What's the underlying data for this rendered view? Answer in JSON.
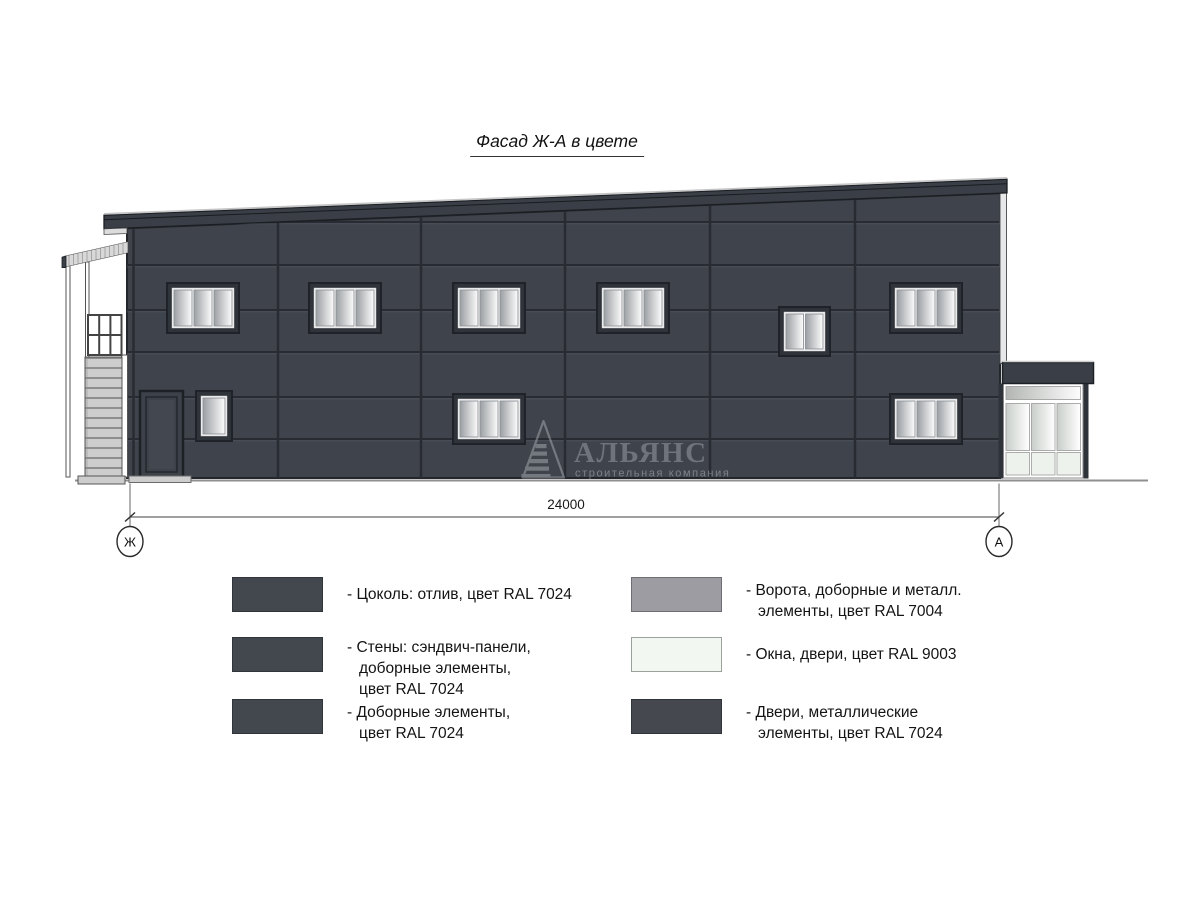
{
  "title": "Фасад Ж-А в цвете",
  "drawing": {
    "dimension_total": "24000",
    "axis_left": "Ж",
    "axis_right": "А",
    "watermark_name": "АЛЬЯНС",
    "watermark_subtitle": "строительная компания"
  },
  "colors": {
    "facade_ral7024": "#3f444c",
    "metal_ral7004": "#9c9ca2",
    "windows_ral9003": "#f2f7f1"
  },
  "legend": {
    "left": [
      {
        "swatch": "#43474e",
        "border": "#30343b",
        "text": "- Цоколь: отлив, цвет RAL 7024"
      },
      {
        "swatch": "#43474e",
        "border": "#30343b",
        "text": "- Стены: сэндвич-панели,\nдоборные элементы,\nцвет RAL 7024"
      },
      {
        "swatch": "#43474e",
        "border": "#30343b",
        "text": "- Доборные элементы,\nцвет RAL 7024"
      }
    ],
    "right": [
      {
        "swatch": "#9c9ca2",
        "border": "#6d6d73",
        "text": "- Ворота, доборные и металл.\nэлементы, цвет RAL 7004"
      },
      {
        "swatch": "#f2f7f1",
        "border": "#9aa29b",
        "text": "- Окна, двери, цвет RAL 9003"
      },
      {
        "swatch": "#45494f",
        "border": "#30343b",
        "text": "- Двери, металлические\nэлементы, цвет RAL 7024"
      }
    ]
  }
}
